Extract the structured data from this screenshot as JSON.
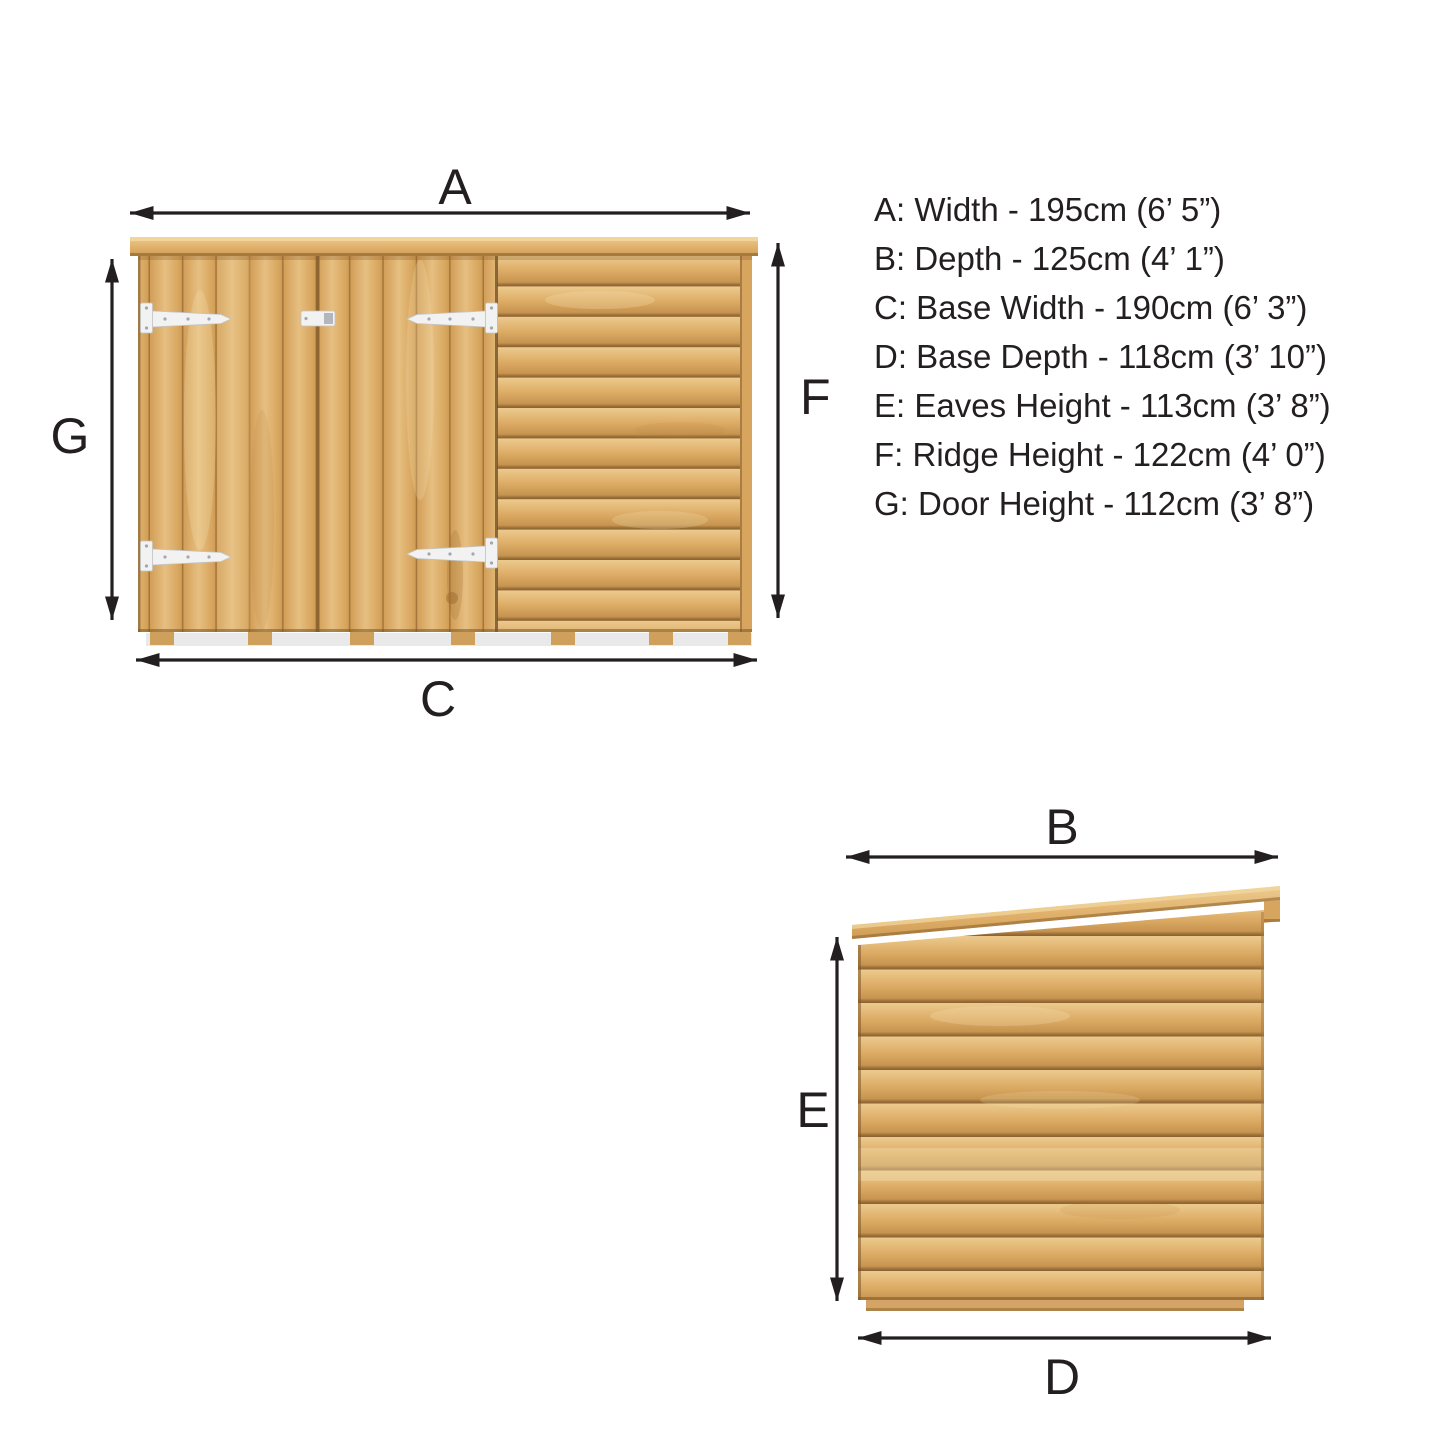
{
  "front_view": {
    "label_width": "A",
    "label_door_height": "G",
    "label_ridge_height": "F",
    "label_base_width": "C"
  },
  "side_view": {
    "label_depth": "B",
    "label_eaves_height": "E",
    "label_base_depth": "D"
  },
  "dimension_list": {
    "lines": [
      "A: Width - 195cm (6’ 5”)",
      "B: Depth - 125cm (4’ 1”)",
      "C: Base Width - 190cm (6’ 3”)",
      "D: Base Depth - 118cm (3’ 10”)",
      "E: Eaves Height - 113cm (3’ 8”)",
      "F: Ridge Height - 122cm (4’ 0”)",
      "G: Door Height - 112cm (3’ 8”)"
    ]
  },
  "colors": {
    "ink": "#231f20",
    "wood_light": "#eed1a0",
    "wood_mid": "#dcaa64",
    "wood_dark": "#8f6531",
    "hinge_white": "#f2f2f3",
    "background": "#ffffff"
  }
}
